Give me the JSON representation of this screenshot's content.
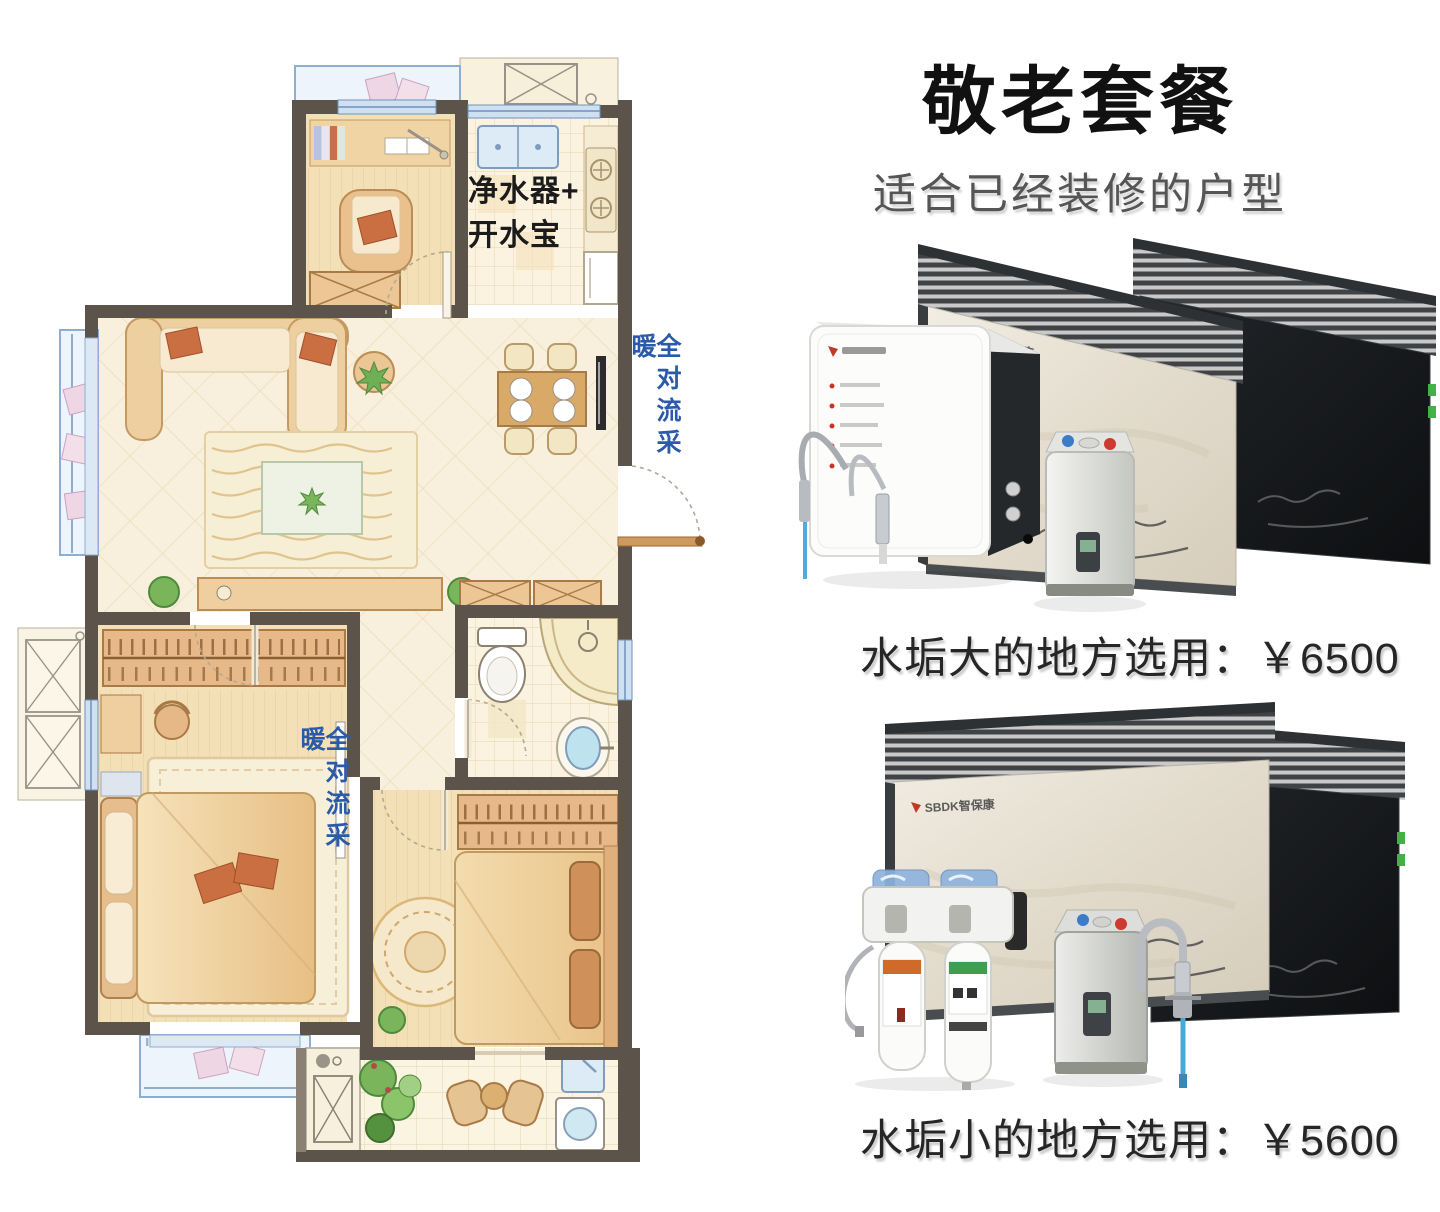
{
  "header": {
    "title": "敬老套餐",
    "subtitle": "适合已经装修的户型"
  },
  "floor_plan": {
    "kitchen_device_label": {
      "line1": "净水器+",
      "line2": "开水宝"
    },
    "heating_label_entry": "全对流采暖",
    "heating_label_bedroom": "全对流采暖"
  },
  "packages": [
    {
      "brand": "SBDK智保康",
      "price_line": "水垢大的地方选用：￥6500"
    },
    {
      "brand": "SBDK智保康",
      "price_line": "水垢小的地方选用：￥5600"
    }
  ],
  "colors": {
    "heating_label": "#2a5aa8",
    "title": "#111111",
    "subtitle": "#555555",
    "price": "#262626",
    "wall": "#5c544a"
  }
}
